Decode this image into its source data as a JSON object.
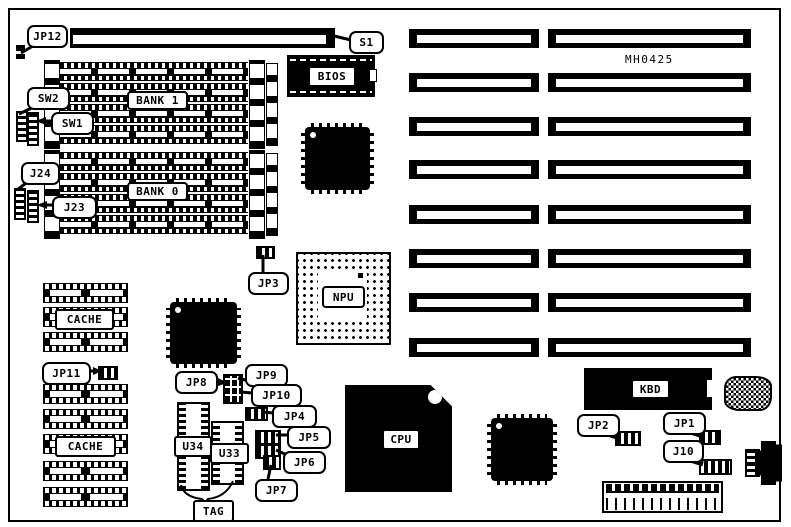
{
  "part_number": "MH0425",
  "colors": {
    "ink": "#000000",
    "paper": "#ffffff"
  },
  "labels": {
    "jp12": "JP12",
    "s1": "S1",
    "sw2": "SW2",
    "sw1": "SW1",
    "bank1": "BANK 1",
    "bank0": "BANK 0",
    "j24": "J24",
    "j23": "J23",
    "bios": "BIOS",
    "jp3": "JP3",
    "npu": "NPU",
    "cache_upper": "CACHE",
    "cache_lower": "CACHE",
    "jp11": "JP11",
    "jp8": "JP8",
    "jp9": "JP9",
    "jp10": "JP10",
    "jp4": "JP4",
    "jp5": "JP5",
    "jp6": "JP6",
    "jp7": "JP7",
    "u34": "U34",
    "u33": "U33",
    "tag": "TAG",
    "cpu": "CPU",
    "kbd": "KBD",
    "jp2": "JP2",
    "jp1": "JP1",
    "j10": "J10"
  }
}
